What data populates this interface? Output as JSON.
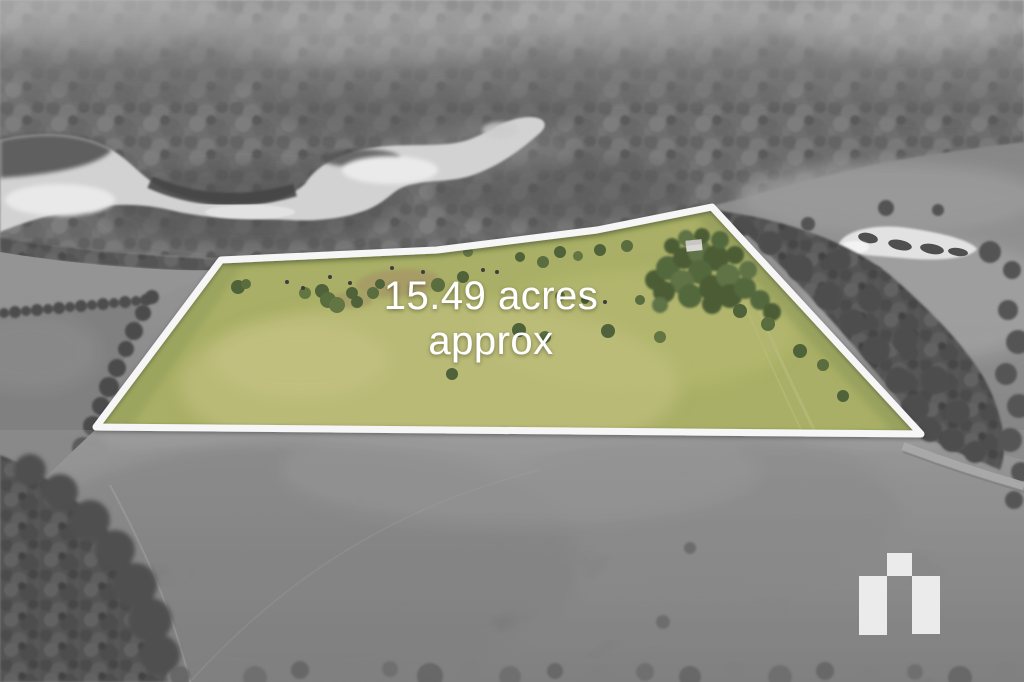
{
  "overlay": {
    "line1": "15.49 acres",
    "line2": "approx",
    "text_color": "#ffffff"
  },
  "boundary": {
    "stroke_color": "#ffffff"
  },
  "parcel": {
    "fill_color": "#a7ae59"
  },
  "branding": {
    "logo_color": "#f1f1f1"
  }
}
